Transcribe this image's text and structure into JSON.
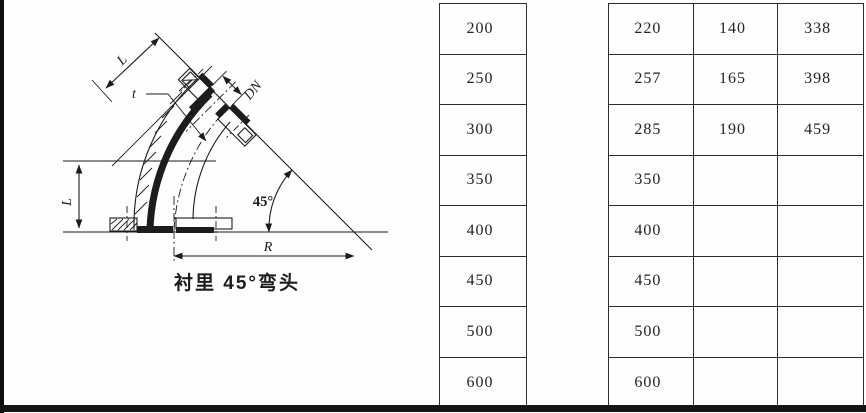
{
  "page": {
    "background": "#fefefe",
    "ink": "#1c1c1c"
  },
  "figure": {
    "caption": "衬里 45°弯头",
    "dim_labels": {
      "length_top": "L",
      "wall_thickness": "t",
      "nominal_diameter": "DN",
      "length_left": "L",
      "angle": "45°",
      "radius": "R"
    }
  },
  "dn_column": {
    "values": [
      "200",
      "250",
      "300",
      "350",
      "400",
      "450",
      "500",
      "600"
    ]
  },
  "dims_table": {
    "rows": [
      [
        "220",
        "140",
        "338"
      ],
      [
        "257",
        "165",
        "398"
      ],
      [
        "285",
        "190",
        "459"
      ],
      [
        "350",
        "",
        ""
      ],
      [
        "400",
        "",
        ""
      ],
      [
        "450",
        "",
        ""
      ],
      [
        "500",
        "",
        ""
      ],
      [
        "600",
        "",
        ""
      ]
    ]
  }
}
